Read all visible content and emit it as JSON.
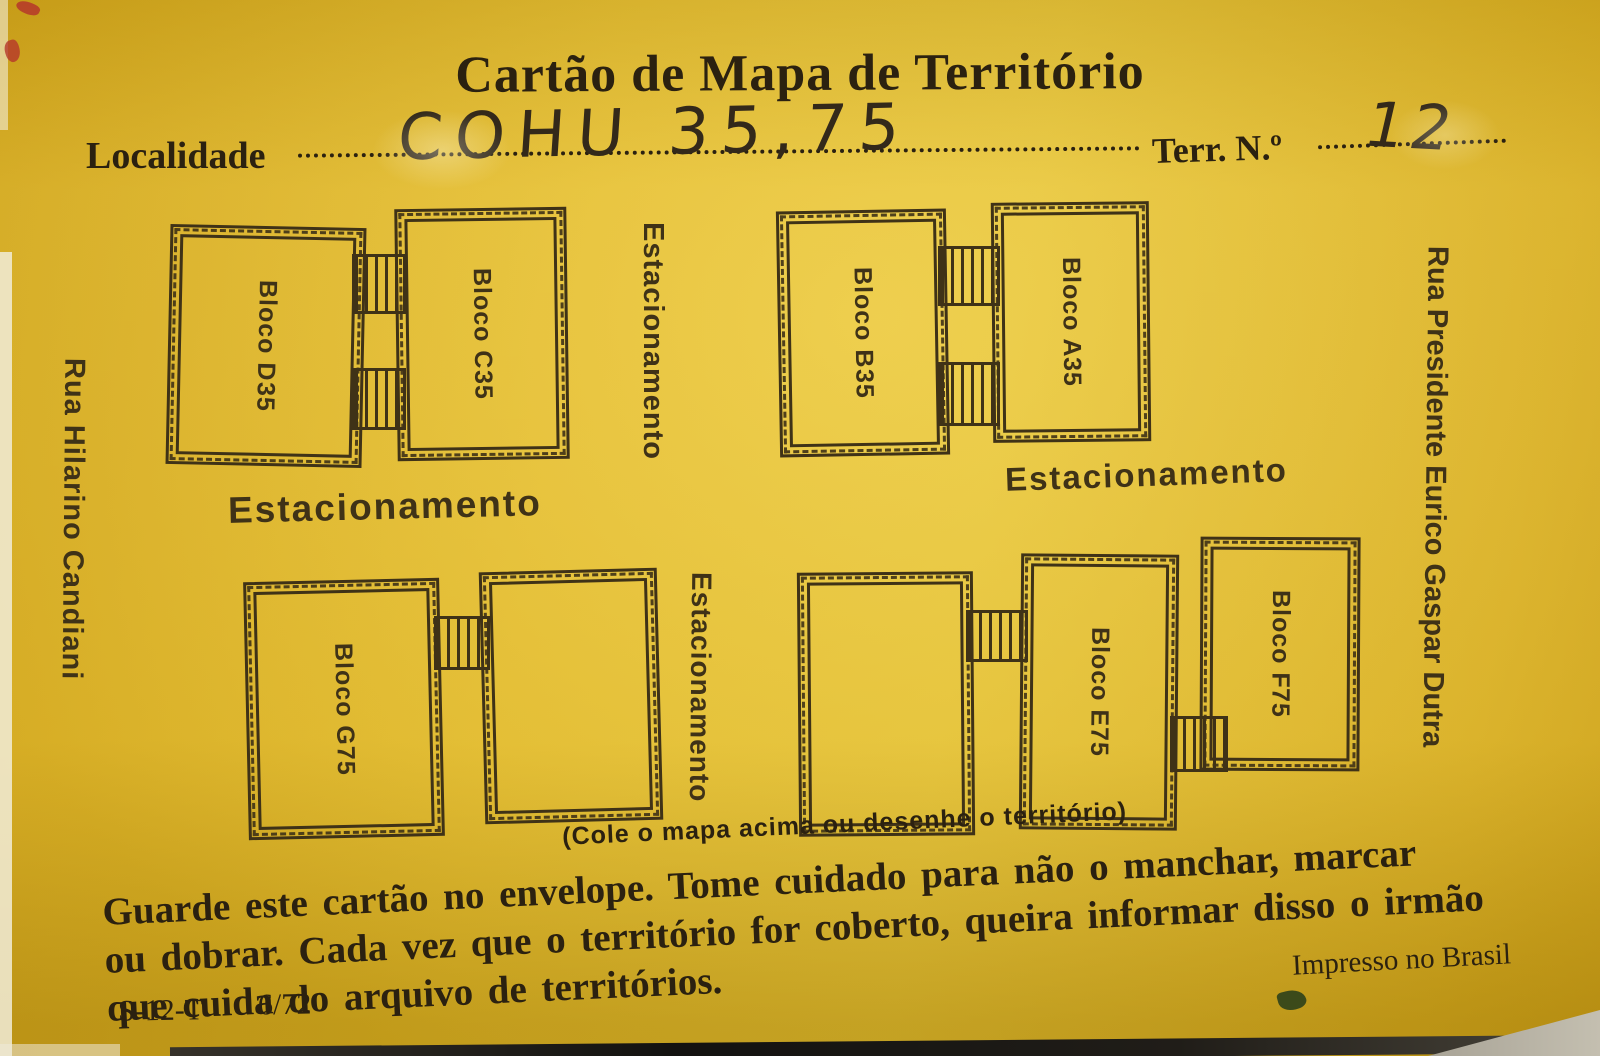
{
  "card": {
    "title": "Cartão de Mapa de Território",
    "locality": {
      "label": "Localidade",
      "value": "COHU 35,75"
    },
    "territory": {
      "label": "Terr. N.º",
      "value": "12"
    },
    "caption": "(Cole o mapa acima ou desenhe o território)",
    "instructions_lines": [
      "Guarde este cartão no envelope. Tome cuidado para não o manchar, marcar",
      "ou dobrar. Cada vez que o território for coberto, queira informar disso o irmão",
      "que cuida do arquivo de territórios."
    ],
    "printed_in": "Impresso no Brasil",
    "form_code": "S-12-T",
    "form_date": "6/72"
  },
  "map": {
    "street_left": "Rua Hilarino Candiani",
    "street_right": "Rua Presidente Eurico Gaspar Dutra",
    "parking": [
      "Estacionamento",
      "Estacionamento",
      "Estacionamento",
      "Estacionamento"
    ],
    "blocks": [
      {
        "name": "Bloco D",
        "number": "35"
      },
      {
        "name": "Bloco C",
        "number": "35"
      },
      {
        "name": "Bloco B",
        "number": "35"
      },
      {
        "name": "Bloco A",
        "number": "35"
      },
      {
        "name": "Bloco G",
        "number": "75"
      },
      {
        "name": "",
        "number": ""
      },
      {
        "name": "",
        "number": ""
      },
      {
        "name": "Bloco E",
        "number": "75"
      },
      {
        "name": "Bloco F",
        "number": "75"
      }
    ]
  },
  "colors": {
    "card": "#e6ba21",
    "ink": "#3f3217",
    "text": "#2b2110",
    "red_mark": "#b5372a"
  }
}
